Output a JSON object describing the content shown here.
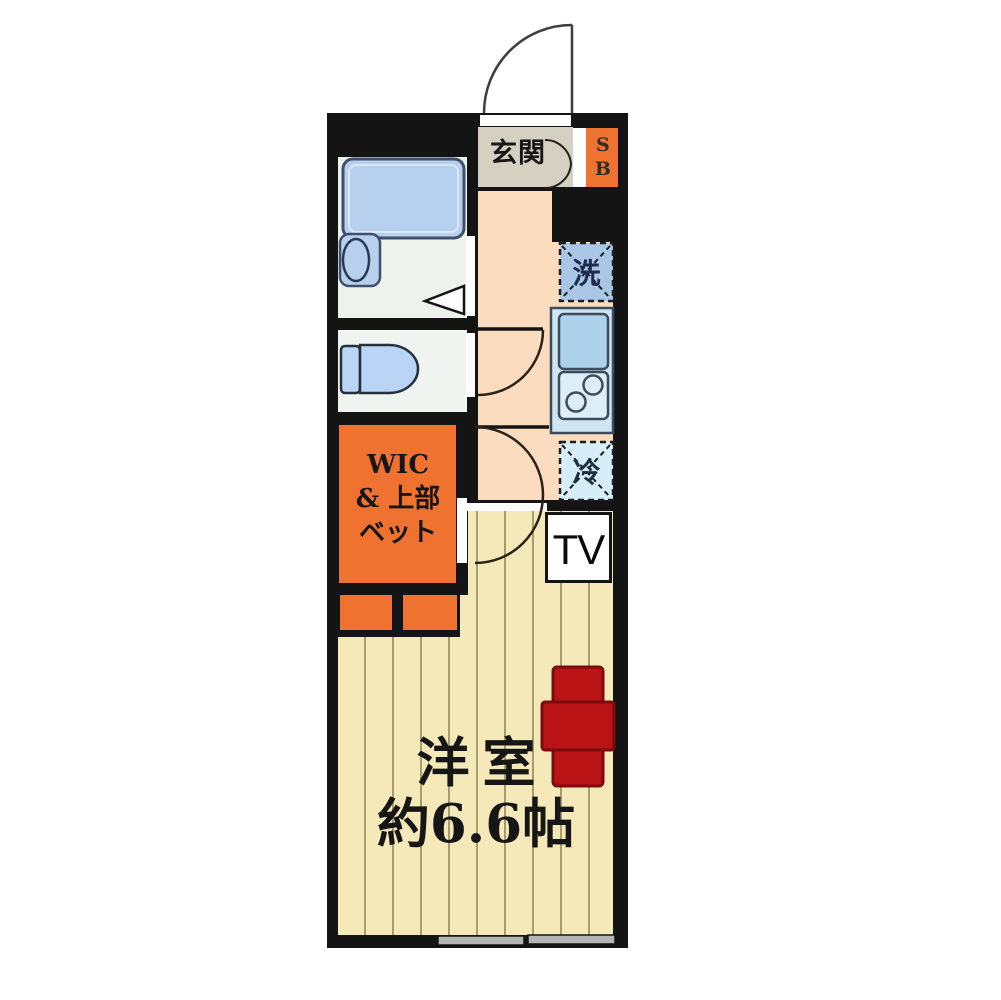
{
  "floorplan": {
    "type": "apartment-floor-plan",
    "labels": {
      "entrance": "玄関",
      "shoe_box": "SB",
      "washing_machine": "洗",
      "refrigerator": "冷",
      "tv": "TV",
      "closet": {
        "line1": "WIC",
        "line2": "& 上部",
        "line3": "ベット"
      },
      "main_room": {
        "name": "洋室",
        "size": "約6.6帖"
      }
    },
    "colors": {
      "wall": "#141414",
      "wood_floor": "#f5e9ba",
      "wood_stripe": "#a79c6e",
      "hallway_floor": "#fbdcbe",
      "entrance_floor": "#d4d1c2",
      "accent_orange": "#ef7231",
      "fixture_blue": "#b6d0ee",
      "washer_blue": "#a9c6e6",
      "fridge_blue": "#d7edf8",
      "kitchen_blue": "#cfe6f2",
      "table_red": "#b91315",
      "bath_floor": "#eef2ec",
      "window_gray": "#b5b5b5"
    }
  }
}
